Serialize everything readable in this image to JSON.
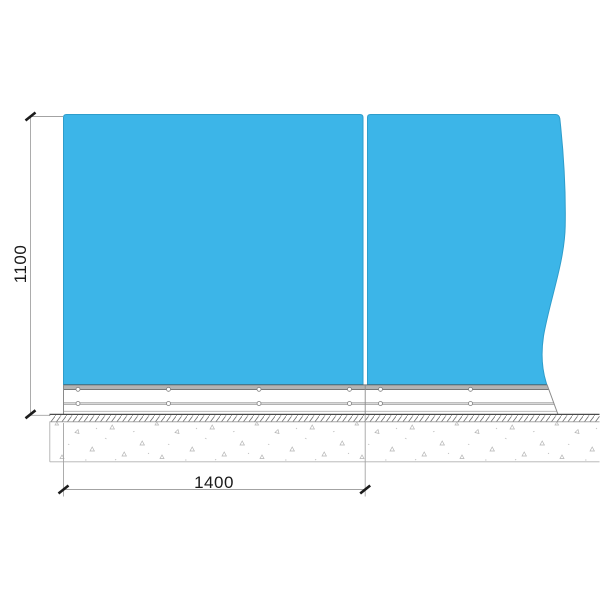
{
  "dimensions": {
    "height_label": "1100",
    "width_label": "1400"
  },
  "colors": {
    "glass": "#3cb5e8",
    "glass_edge": "#2e9dcb",
    "rail_fill": "#b3b3b3",
    "rail_line": "#8a8a8a",
    "ground_line": "#4a4a4a",
    "hatch_line": "#6e6e6e",
    "concrete_speckle": "#b4b4b4",
    "dimension_line": "#a3a3a3",
    "tick": "#1c1c1c",
    "dimension_text": "#1a1a1a",
    "background": "#ffffff"
  }
}
